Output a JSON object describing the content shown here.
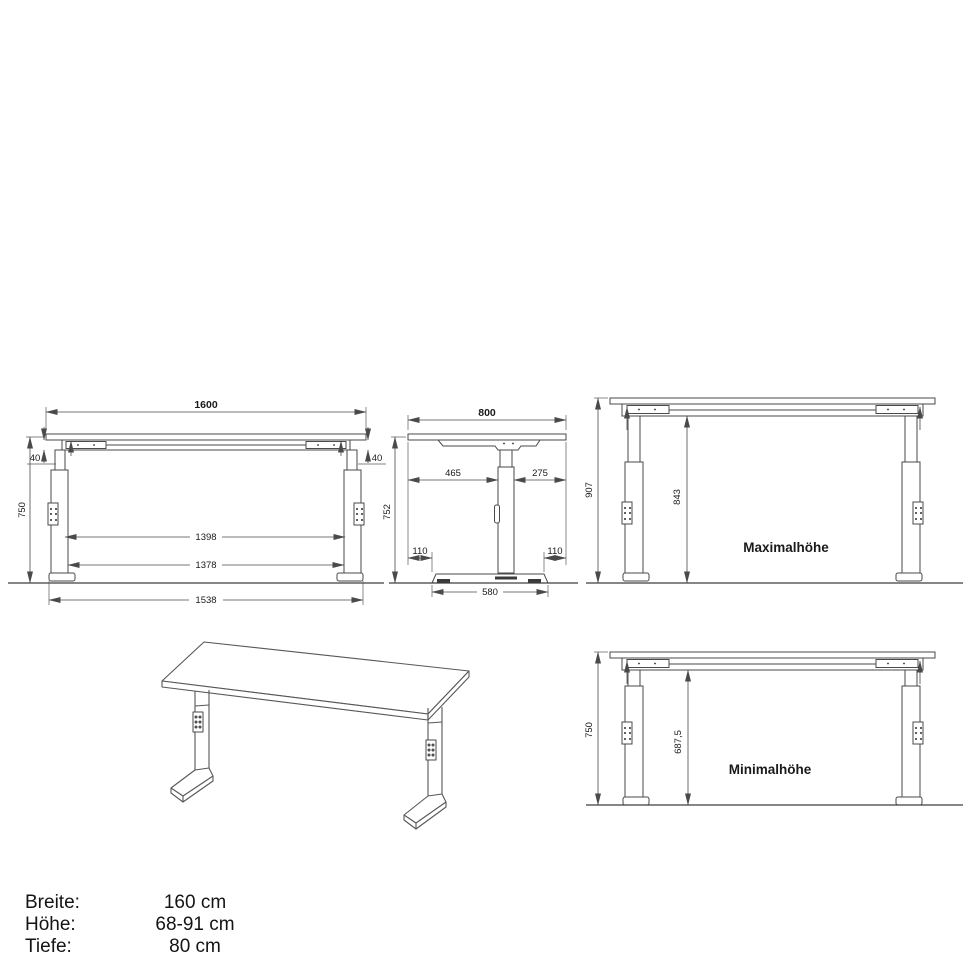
{
  "front_view": {
    "dim_width_top": "1600",
    "dim_overhang_left": "40",
    "dim_overhang_right": "40",
    "dim_height": "750",
    "dim_inner_upper": "1398",
    "dim_inner_lower": "1378",
    "dim_foot_span": "1538"
  },
  "side_view": {
    "dim_depth": "800",
    "dim_top_left": "465",
    "dim_top_right": "275",
    "dim_height": "752",
    "dim_foot_inset_left": "110",
    "dim_foot_inset_right": "110",
    "dim_foot_length": "580"
  },
  "max_height_view": {
    "label": "Maximalhöhe",
    "dim_total_height": "907",
    "dim_clearance": "843"
  },
  "min_height_view": {
    "label": "Minimalhöhe",
    "dim_total_height": "750",
    "dim_clearance": "687,5"
  },
  "specs": {
    "rows": [
      {
        "label": "Breite:",
        "value": "160 cm"
      },
      {
        "label": "Höhe:",
        "value": "68-91 cm"
      },
      {
        "label": "Tiefe:",
        "value": "80 cm"
      }
    ]
  },
  "style": {
    "line_color": "#4a4a4a",
    "text_color": "#1a1a1a",
    "background": "#ffffff"
  }
}
